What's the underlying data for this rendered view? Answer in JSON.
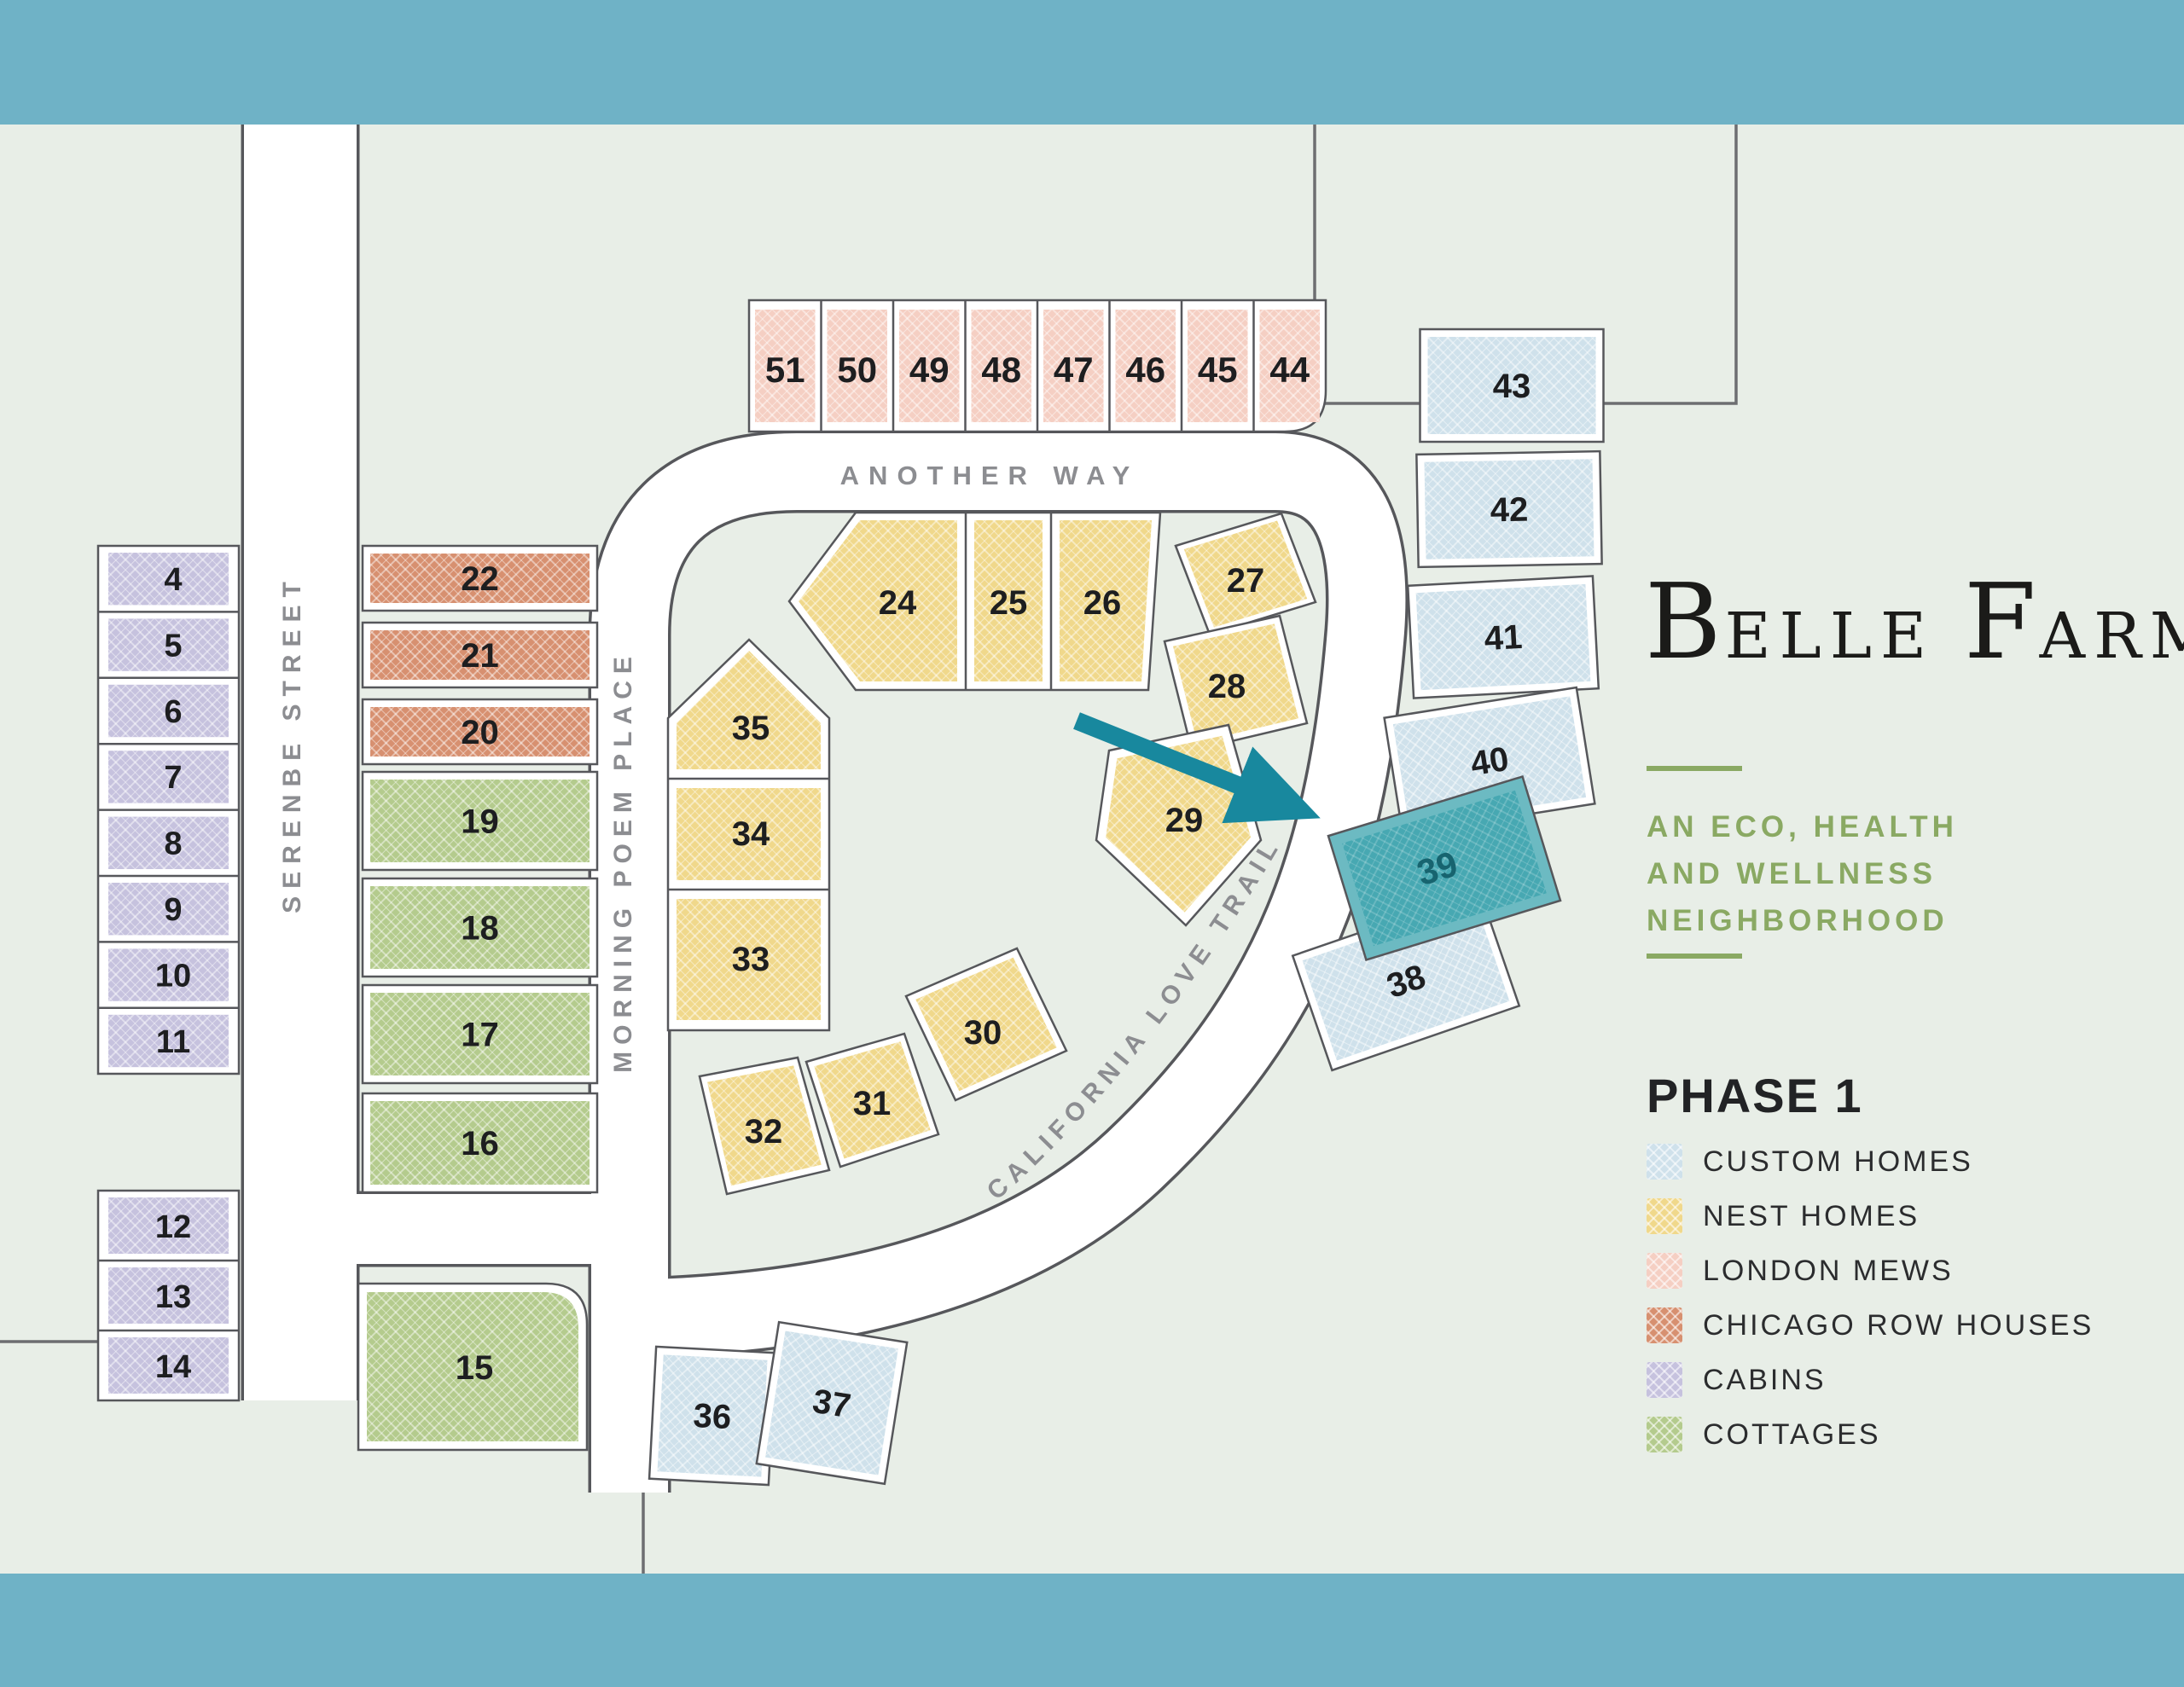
{
  "map": {
    "streets": [
      {
        "id": "serenbe",
        "name": "SERENBE STREET"
      },
      {
        "id": "morning-poem",
        "name": "MORNING POEM PLACE"
      },
      {
        "id": "another-way",
        "name": "ANOTHER WAY"
      },
      {
        "id": "california-love",
        "name": "CALIFORNIA LOVE TRAIL"
      }
    ],
    "selected_lot": "39",
    "lots": [
      {
        "number": "4",
        "type": "cabins"
      },
      {
        "number": "5",
        "type": "cabins"
      },
      {
        "number": "6",
        "type": "cabins"
      },
      {
        "number": "7",
        "type": "cabins"
      },
      {
        "number": "8",
        "type": "cabins"
      },
      {
        "number": "9",
        "type": "cabins"
      },
      {
        "number": "10",
        "type": "cabins"
      },
      {
        "number": "11",
        "type": "cabins"
      },
      {
        "number": "12",
        "type": "cabins"
      },
      {
        "number": "13",
        "type": "cabins"
      },
      {
        "number": "14",
        "type": "cabins"
      },
      {
        "number": "15",
        "type": "cottages"
      },
      {
        "number": "16",
        "type": "cottages"
      },
      {
        "number": "17",
        "type": "cottages"
      },
      {
        "number": "18",
        "type": "cottages"
      },
      {
        "number": "19",
        "type": "cottages"
      },
      {
        "number": "20",
        "type": "chicago"
      },
      {
        "number": "21",
        "type": "chicago"
      },
      {
        "number": "22",
        "type": "chicago"
      },
      {
        "number": "24",
        "type": "nest"
      },
      {
        "number": "25",
        "type": "nest"
      },
      {
        "number": "26",
        "type": "nest"
      },
      {
        "number": "27",
        "type": "nest"
      },
      {
        "number": "28",
        "type": "nest"
      },
      {
        "number": "29",
        "type": "nest"
      },
      {
        "number": "30",
        "type": "nest"
      },
      {
        "number": "31",
        "type": "nest"
      },
      {
        "number": "32",
        "type": "nest"
      },
      {
        "number": "33",
        "type": "nest"
      },
      {
        "number": "34",
        "type": "nest"
      },
      {
        "number": "35",
        "type": "nest"
      },
      {
        "number": "36",
        "type": "custom"
      },
      {
        "number": "37",
        "type": "custom"
      },
      {
        "number": "38",
        "type": "custom"
      },
      {
        "number": "39",
        "type": "custom"
      },
      {
        "number": "40",
        "type": "custom"
      },
      {
        "number": "41",
        "type": "custom"
      },
      {
        "number": "42",
        "type": "custom"
      },
      {
        "number": "43",
        "type": "custom"
      },
      {
        "number": "44",
        "type": "mews"
      },
      {
        "number": "45",
        "type": "mews"
      },
      {
        "number": "46",
        "type": "mews"
      },
      {
        "number": "47",
        "type": "mews"
      },
      {
        "number": "48",
        "type": "mews"
      },
      {
        "number": "49",
        "type": "mews"
      },
      {
        "number": "50",
        "type": "mews"
      },
      {
        "number": "51",
        "type": "mews"
      }
    ]
  },
  "branding": {
    "logo_initial_1": "B",
    "logo_rest_1": "ELLE",
    "logo_initial_2": "F",
    "logo_rest_2": "ARM",
    "tagline_line1": "AN ECO, HEALTH",
    "tagline_line2": "AND WELLNESS",
    "tagline_line3": "NEIGHBORHOOD"
  },
  "legend": {
    "heading": "PHASE 1",
    "items": [
      {
        "label": "CUSTOM HOMES",
        "type": "custom",
        "color": "#cfe1eb"
      },
      {
        "label": "NEST HOMES",
        "type": "nest",
        "color": "#f0d88b"
      },
      {
        "label": "LONDON MEWS",
        "type": "mews",
        "color": "#f5cfc3"
      },
      {
        "label": "CHICAGO ROW HOUSES",
        "type": "chicago",
        "color": "#d79070"
      },
      {
        "label": "CABINS",
        "type": "cabins",
        "color": "#c6c2de"
      },
      {
        "label": "COTTAGES",
        "type": "cottages",
        "color": "#b4cb8d"
      }
    ]
  },
  "colors": {
    "background": "#e8eee7",
    "water_band": "#6fb2c6",
    "road_fill": "#ffffff",
    "road_stroke": "#56575b",
    "boundary_line": "#6d6e71",
    "number_text": "#1d1e20",
    "street_label": "#8c8d91",
    "arrow": "#18889e",
    "selected_fill": "#47a8b2",
    "selected_ring": "#6cbac2",
    "selected_text": "#17646f",
    "tagline_green": "#8aa963"
  }
}
